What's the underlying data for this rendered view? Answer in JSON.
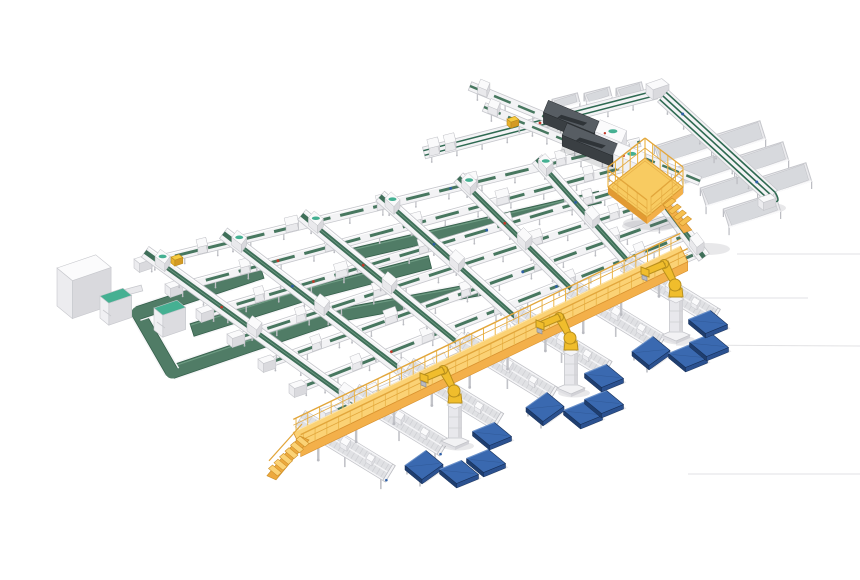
{
  "palette": {
    "bg": "#ffffff",
    "green_belt": "#47775f",
    "green_belt_dark": "#35604b",
    "green_belt_light": "#6f9d84",
    "green_wide": "#507c66",
    "green_lane": "#2f6a52",
    "teal": "#45b092",
    "frame_white": "#f3f3f5",
    "frame_light": "#e9e9ec",
    "frame_mid": "#d6d6db",
    "frame_dark": "#babbc1",
    "frame_edge": "#c6c7cc",
    "leg": "#c2c3c8",
    "dark_top": "#575d63",
    "dark_front": "#3a3f43",
    "dark_end": "#2d3135",
    "deck_top": "#fbd275",
    "deck_mid": "#f3b04a",
    "deck_deep": "#e29a33",
    "rail_yellow": "#ecb84e",
    "rail_line": "#e2a63b",
    "step_top": "#f6c050",
    "robot_yellow": "#f0bd2c",
    "robot_shade": "#b88f1c",
    "pallet_top": "#3a69b0",
    "pallet_left": "#1f3e6f",
    "pallet_right": "#2b5190",
    "pallet_stroke": "#16305a",
    "pallet_hl": "#6c93cc",
    "red_dot": "#c13b2a",
    "blue_dot": "#2e5fa6",
    "pkg_top": "#f6cb41",
    "pkg_left": "#e8b22e",
    "pkg_right": "#d49a24",
    "shadow": "rgba(110,112,122,0.16)",
    "floor_line": "#e2e2e4"
  },
  "canvas": {
    "w": 860,
    "h": 580
  },
  "floor_lines": [
    [
      737,
      254,
      860,
      254
    ],
    [
      700,
      298,
      808,
      298
    ],
    [
      676,
      345,
      860,
      346
    ],
    [
      688,
      474,
      860,
      474
    ]
  ],
  "floor_shadows": [
    {
      "cx": 708,
      "cy": 249,
      "rx": 22,
      "ry": 6
    },
    {
      "cx": 770,
      "cy": 208,
      "rx": 16,
      "ry": 5
    },
    {
      "cx": 648,
      "cy": 226,
      "rx": 26,
      "ry": 6
    }
  ],
  "array": {
    "rows": {
      "s0": [
        142,
        264
      ],
      "s6": [
        328,
        414
      ],
      "e0": [
        640,
        142
      ],
      "e6": [
        700,
        252
      ],
      "count": 7,
      "width": 9,
      "box_ts": [
        0.12,
        0.3,
        0.48,
        0.66,
        0.84
      ],
      "red_t": 0.2,
      "blue_t": 0.62
    },
    "cols": {
      "u": [
        0.03,
        0.185,
        0.34,
        0.495,
        0.65,
        0.805,
        0.96
      ],
      "width": 13,
      "box_ts": [
        0.08,
        0.5,
        0.92
      ]
    }
  },
  "wide_belts": [
    {
      "pts": [
        [
          172,
          372
        ],
        [
          340,
          315
        ],
        [
          480,
          289
        ]
      ],
      "w": 13
    },
    {
      "pts": [
        [
          192,
          330
        ],
        [
          300,
          296
        ],
        [
          430,
          262
        ]
      ],
      "w": 13
    },
    {
      "pts": [
        [
          350,
          255
        ],
        [
          600,
          197
        ]
      ],
      "w": 12
    }
  ],
  "loop": {
    "legs": [
      [
        [
          138,
          313
        ],
        [
          172,
          372
        ]
      ],
      [
        [
          138,
          313
        ],
        [
          262,
          272
        ]
      ]
    ],
    "w": 13
  },
  "cabinets": [
    {
      "p": [
        100,
        296
      ],
      "a": 26,
      "b": 16,
      "h": 22
    },
    {
      "p": [
        154,
        308
      ],
      "a": 26,
      "b": 16,
      "h": 22
    }
  ],
  "big_box": {
    "p": [
      57,
      268
    ],
    "a": 44,
    "b": 28,
    "h": 38
  },
  "box_link": {
    "a": [
      112,
      296
    ],
    "b": [
      142,
      288
    ],
    "w": 6
  },
  "top_feed": {
    "a": [
      424,
      153
    ],
    "b": [
      656,
      93
    ],
    "w": 12,
    "box_ts": [
      0.04,
      0.11
    ],
    "troughs": [
      [
        566,
        101
      ],
      [
        598,
        95
      ],
      [
        630,
        90
      ]
    ],
    "trough_dir": [
      0.97,
      -0.25
    ]
  },
  "corner": {
    "p": [
      646,
      84
    ],
    "a": 18,
    "b": 13,
    "h": 10
  },
  "spine": {
    "a": [
      663,
      96
    ],
    "b": [
      772,
      196
    ],
    "w": 16,
    "lane_off": [
      -4.8,
      0,
      4.8
    ],
    "end_box": [
      762,
      196
    ]
  },
  "chutes": {
    "dir": [
      0.955,
      -0.3
    ],
    "len": 54,
    "w": 19,
    "left": [
      [
        683,
        147
      ],
      [
        706,
        168
      ],
      [
        729,
        189
      ],
      [
        752,
        210
      ]
    ],
    "right": [
      [
        737,
        138
      ],
      [
        760,
        159
      ],
      [
        783,
        180
      ]
    ]
  },
  "mlines": [
    {
      "a": [
        470,
        86
      ],
      "b": [
        700,
        181
      ],
      "mach": [
        0.33,
        0.55
      ],
      "house": [
        0.555,
        0.67
      ]
    },
    {
      "a": [
        484,
        107
      ],
      "b": [
        652,
        176
      ],
      "mach": [
        0.48,
        0.78
      ],
      "house": [
        0.785,
        0.95
      ]
    }
  ],
  "platform": {
    "L": [
      608,
      187
    ],
    "T": [
      645,
      158
    ],
    "R": [
      683,
      187
    ],
    "B": [
      647,
      217
    ],
    "rail_h": 20,
    "skirt": 7,
    "stairs": {
      "from": [
        663,
        205
      ],
      "step": [
        5.2,
        6.0
      ],
      "n": 4,
      "wvec": [
        9,
        -7
      ]
    }
  },
  "walkway": {
    "a": [
      297,
      440
    ],
    "b": [
      684,
      254
    ],
    "w": 17,
    "skirt": 9,
    "rail_h": 13,
    "legs_every": 42,
    "stairs": {
      "top": [
        300,
        436
      ],
      "n": 6,
      "step": [
        -5.5,
        5.8
      ],
      "wvec": [
        9,
        7.5
      ]
    }
  },
  "outfeeds": {
    "f": [
      0.055,
      0.195,
      0.335,
      0.475,
      0.615,
      0.755,
      0.895
    ],
    "back": [
      18,
      11
    ],
    "fwd": [
      72,
      44
    ],
    "w": 19
  },
  "robots": [
    [
      455,
      441
    ],
    [
      571,
      388
    ],
    [
      676,
      335
    ]
  ],
  "pallets": [
    {
      "c": [
        424,
        465
      ],
      "tilt": true
    },
    {
      "c": [
        459,
        472
      ],
      "tilt": false
    },
    {
      "c": [
        486,
        461
      ],
      "tilt": false
    },
    {
      "c": [
        492,
        434
      ],
      "tilt": false
    },
    {
      "c": [
        545,
        407
      ],
      "tilt": true
    },
    {
      "c": [
        583,
        413
      ],
      "tilt": false
    },
    {
      "c": [
        604,
        402
      ],
      "tilt": false
    },
    {
      "c": [
        604,
        376
      ],
      "tilt": false
    },
    {
      "c": [
        651,
        351
      ],
      "tilt": true
    },
    {
      "c": [
        688,
        356
      ],
      "tilt": false
    },
    {
      "c": [
        709,
        345
      ],
      "tilt": false
    },
    {
      "c": [
        708,
        322
      ],
      "tilt": false
    }
  ],
  "packages": [
    [
      171,
      257
    ],
    [
      507,
      119
    ]
  ]
}
